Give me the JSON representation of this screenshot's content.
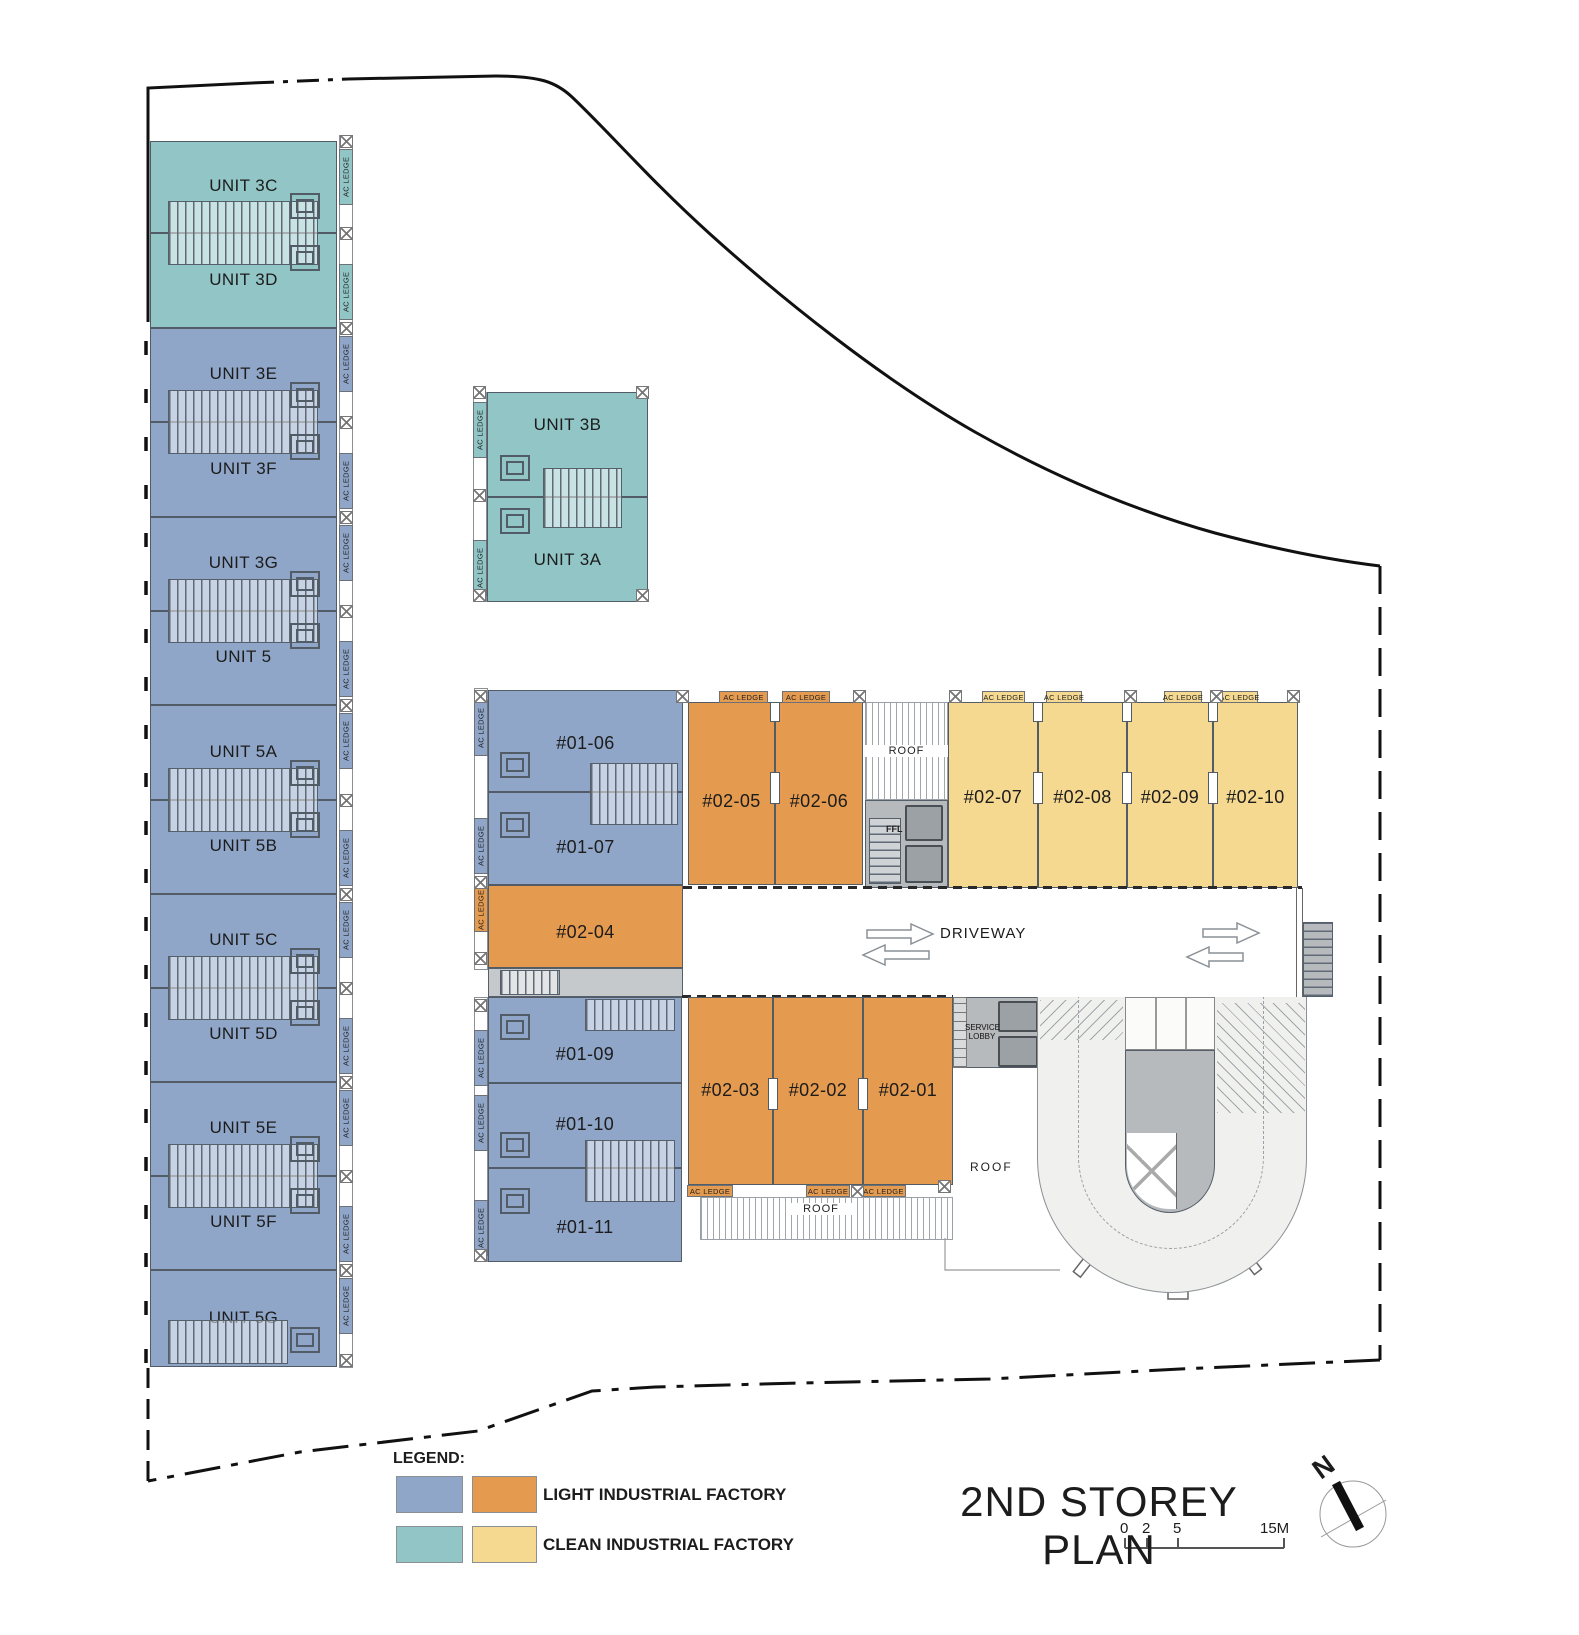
{
  "colors": {
    "light_industrial_blue": "#8FA6C8",
    "light_industrial_orange": "#E49A4F",
    "clean_industrial_teal": "#92C5C6",
    "clean_industrial_yellow": "#F6D990",
    "core_gray": "#B7BABC",
    "driveway_gray": "#F0F0EE",
    "boundary_black": "#111111"
  },
  "labels": {
    "ac_ledge": "AC LEDGE",
    "roof": "ROOF",
    "ffl": "FFL",
    "driveway": "DRIVEWAY",
    "service_lobby_line1": "SERVICE",
    "service_lobby_line2": "LOBBY",
    "north": "N"
  },
  "left_wing_units": [
    {
      "label": "UNIT 3C",
      "type": "clean"
    },
    {
      "label": "UNIT 3D",
      "type": "clean"
    },
    {
      "label": "UNIT 3E",
      "type": "light"
    },
    {
      "label": "UNIT 3F",
      "type": "light"
    },
    {
      "label": "UNIT 3G",
      "type": "light"
    },
    {
      "label": "UNIT 5",
      "type": "light"
    },
    {
      "label": "UNIT 5A",
      "type": "light"
    },
    {
      "label": "UNIT 5B",
      "type": "light"
    },
    {
      "label": "UNIT 5C",
      "type": "light"
    },
    {
      "label": "UNIT 5D",
      "type": "light"
    },
    {
      "label": "UNIT 5E",
      "type": "light"
    },
    {
      "label": "UNIT 5F",
      "type": "light"
    },
    {
      "label": "UNIT 5G",
      "type": "light"
    }
  ],
  "annex_units": [
    {
      "label": "UNIT 3B",
      "type": "clean"
    },
    {
      "label": "UNIT 3A",
      "type": "clean"
    }
  ],
  "central_units": {
    "blue_top": [
      {
        "label": "#01-06"
      },
      {
        "label": "#01-07"
      }
    ],
    "orange_west": {
      "label": "#02-04"
    },
    "blue_bottom": [
      {
        "label": "#01-09"
      },
      {
        "label": "#01-10"
      },
      {
        "label": "#01-11"
      }
    ],
    "orange_top": [
      {
        "label": "#02-05"
      },
      {
        "label": "#02-06"
      }
    ],
    "yellow_row": [
      {
        "label": "#02-07"
      },
      {
        "label": "#02-08"
      },
      {
        "label": "#02-09"
      },
      {
        "label": "#02-10"
      }
    ],
    "orange_bottom": [
      {
        "label": "#02-03"
      },
      {
        "label": "#02-02"
      },
      {
        "label": "#02-01"
      }
    ]
  },
  "legend": {
    "heading": "LEGEND:",
    "items": [
      {
        "label": "LIGHT INDUSTRIAL FACTORY",
        "colors": [
          "#8FA6C8",
          "#E49A4F"
        ]
      },
      {
        "label": "CLEAN INDUSTRIAL FACTORY",
        "colors": [
          "#92C5C6",
          "#F6D990"
        ]
      }
    ]
  },
  "title_block": {
    "title": "2ND STOREY PLAN",
    "scale_ticks": [
      "0",
      "2",
      "5",
      "15M"
    ]
  }
}
